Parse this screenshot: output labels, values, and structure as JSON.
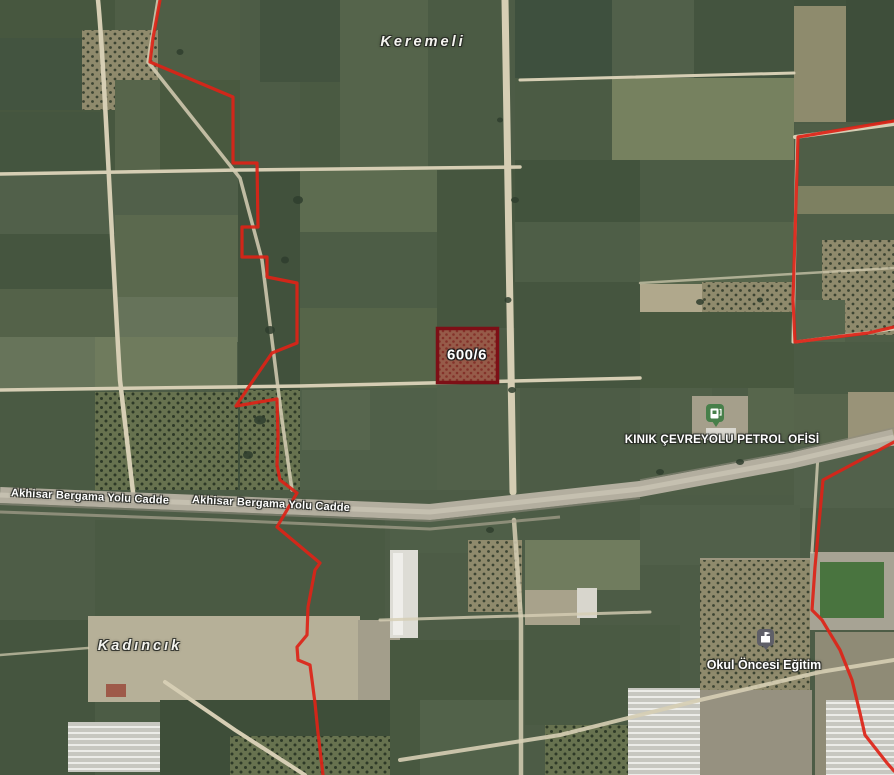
{
  "map": {
    "view": "satellite",
    "labels": {
      "keremeli": "Keremeli",
      "kadincik": "Kadıncık",
      "petrol_ofisi": "KINIK ÇEVREYOLU PETROL OFİSİ",
      "okul_oncesi": "Okul Öncesi Eğitim",
      "road_left": "Akhisar Bergama Yolu Cadde",
      "road_right": "Akhisar Bergama Yolu Cadde"
    },
    "parcel": {
      "label": "600/6",
      "fill_color": "#a83b33",
      "border_color": "#7d0f16"
    },
    "boundary": {
      "color": "#dd2317"
    },
    "icons": {
      "gas_station_color": "#477f4a",
      "school_color": "#5f5f68"
    }
  }
}
